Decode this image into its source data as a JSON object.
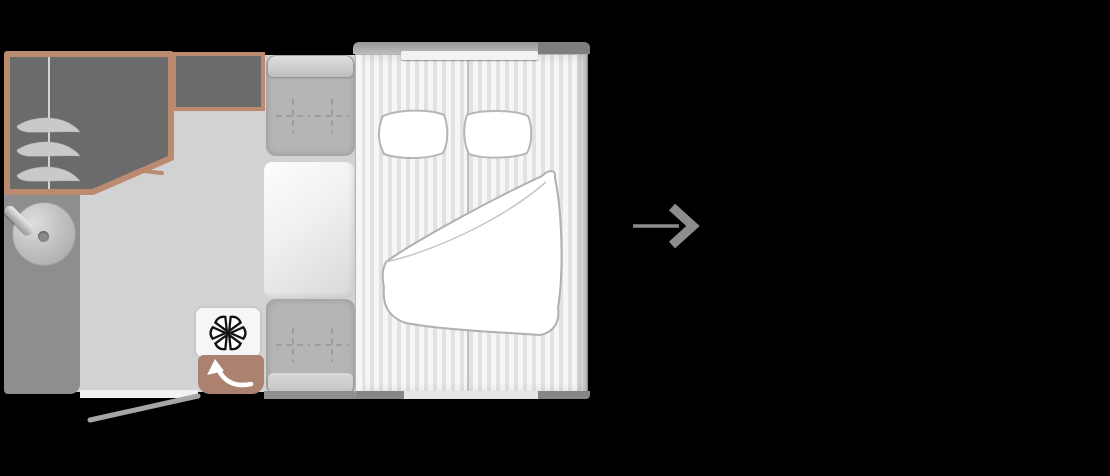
{
  "scene": {
    "description": "caravan floor plan on black background with a next arrow to its right",
    "visible_text": ""
  },
  "palette": {
    "background": "#000000",
    "floor": "#d2d2d2",
    "counter": "#8e8e8e",
    "cabinet_fill": "#6b6b6b",
    "accent_tan": "#bb8b71",
    "door_tan": "#ac8170",
    "seat": "#b5b5b5",
    "table_light": "#fdfdfd",
    "bed_stripe_light": "#f6f6f6",
    "bed_stripe_dark": "#e2e2e2",
    "white": "#ffffff",
    "outline_gray": "#b3b3b3",
    "arrow_gray": "#8d8d8d",
    "fan_black": "#111111"
  },
  "floorplan": {
    "name": "caravan-floorplan",
    "zones": [
      {
        "name": "wardrobe",
        "features": [
          "tan-outline",
          "vertical-divider",
          "three-shelf-blades",
          "angled-corner"
        ]
      },
      {
        "name": "overhead-cabinet",
        "features": [
          "tan-outline"
        ]
      },
      {
        "name": "washroom-counter",
        "features": [
          "round-sink",
          "faucet"
        ]
      },
      {
        "name": "dinette-front-seat",
        "stitch_marks": 2
      },
      {
        "name": "dinette-table"
      },
      {
        "name": "dinette-rear-seat",
        "stitch_marks": 2
      },
      {
        "name": "heater",
        "icon": "fan-icon"
      },
      {
        "name": "entry-door",
        "icon": "door-swing-arrow-icon"
      },
      {
        "name": "doorway-opening"
      },
      {
        "name": "open-door-line"
      },
      {
        "name": "double-bed",
        "features": [
          "head-shelf",
          "pillow-left",
          "pillow-right",
          "duvet",
          "split-mattress"
        ]
      }
    ]
  },
  "next": {
    "icon": "arrow-right-icon"
  }
}
